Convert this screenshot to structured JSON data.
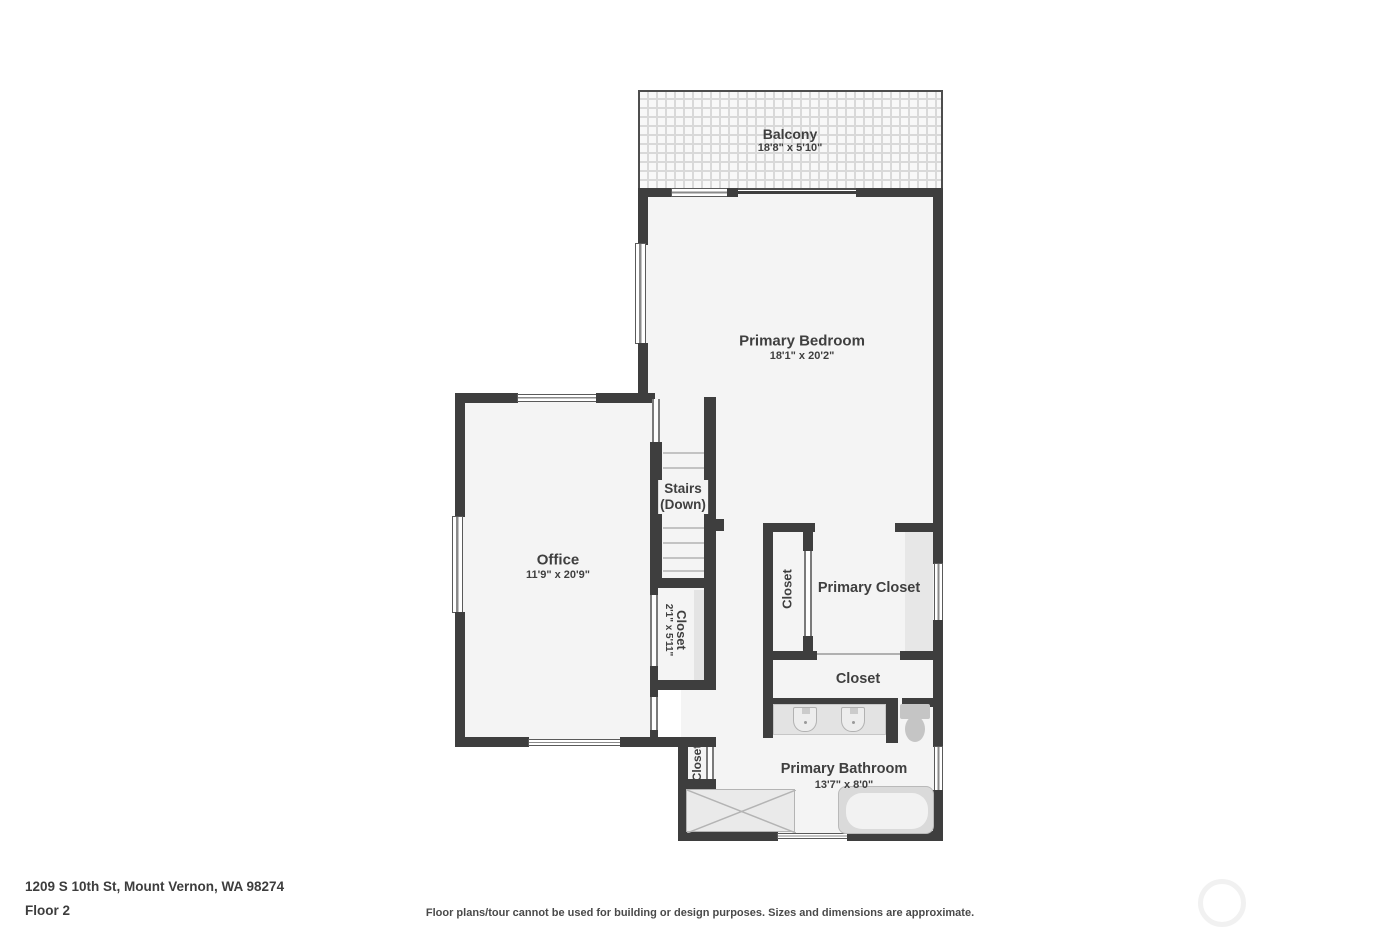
{
  "meta": {
    "address": "1209 S 10th St, Mount Vernon, WA 98274",
    "floor_label": "Floor 2",
    "disclaimer": "Floor plans/tour cannot be used for building or design purposes. Sizes and dimensions are approximate."
  },
  "colors": {
    "wall": "#3e3e3e",
    "floor": "#f4f4f4",
    "fixture_fill": "#e3e3e3",
    "text": "#3f3f3f"
  },
  "rooms": {
    "balcony": {
      "name": "Balcony",
      "dims": "18'8\" x 5'10\""
    },
    "primary_bedroom": {
      "name": "Primary Bedroom",
      "dims": "18'1\" x 20'2\""
    },
    "office": {
      "name": "Office",
      "dims": "11'9\" x 20'9\""
    },
    "stairs": {
      "name": "Stairs",
      "direction": "(Down)"
    },
    "stairs_closet": {
      "name": "Closet",
      "dims": "2'1\" x 5'11\""
    },
    "suite_closet_small": {
      "name": "Closet"
    },
    "primary_closet": {
      "name": "Primary Closet"
    },
    "closet_row": {
      "name": "Closet"
    },
    "primary_bathroom": {
      "name": "Primary Bathroom",
      "dims": "13'7\" x 8'0\""
    },
    "bathroom_closet": {
      "name": "Closet"
    }
  }
}
